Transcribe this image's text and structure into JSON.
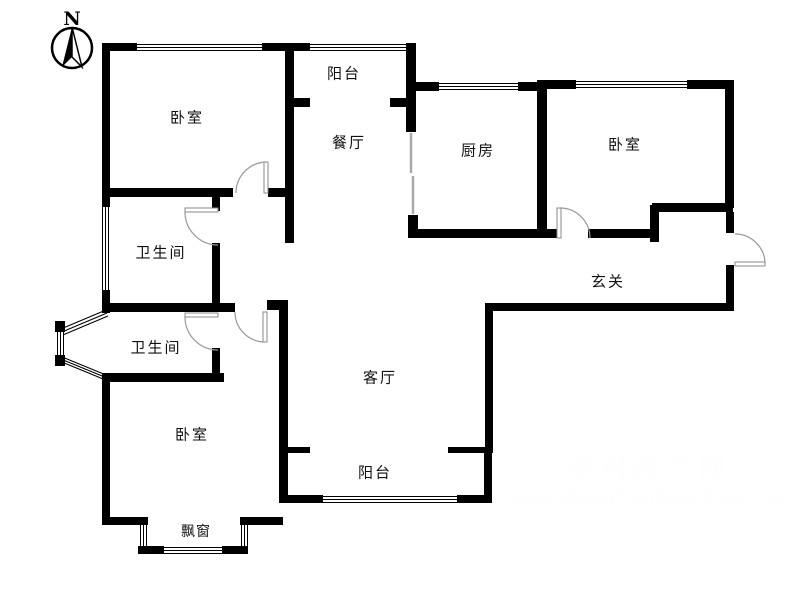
{
  "compass": {
    "label": "N"
  },
  "rooms": {
    "bedroom_top_left": "卧室",
    "balcony_top": "阳台",
    "dining_room": "餐厅",
    "kitchen": "厨房",
    "bedroom_top_right": "卧室",
    "bathroom_upper": "卫生间",
    "bathroom_lower": "卫生间",
    "entry_hall": "玄关",
    "living_room": "客厅",
    "bedroom_bottom": "卧室",
    "balcony_bottom": "阳台",
    "bay_window": "飘窗"
  },
  "watermark": {
    "site_name": "涿州房产网",
    "site_url": "www.zhuozhoufangchan.com",
    "color": "#9a9a9a"
  },
  "colors": {
    "wall": "#000000",
    "door_arc": "#999999",
    "background": "#ffffff",
    "watermark": "#9a9a9a"
  }
}
